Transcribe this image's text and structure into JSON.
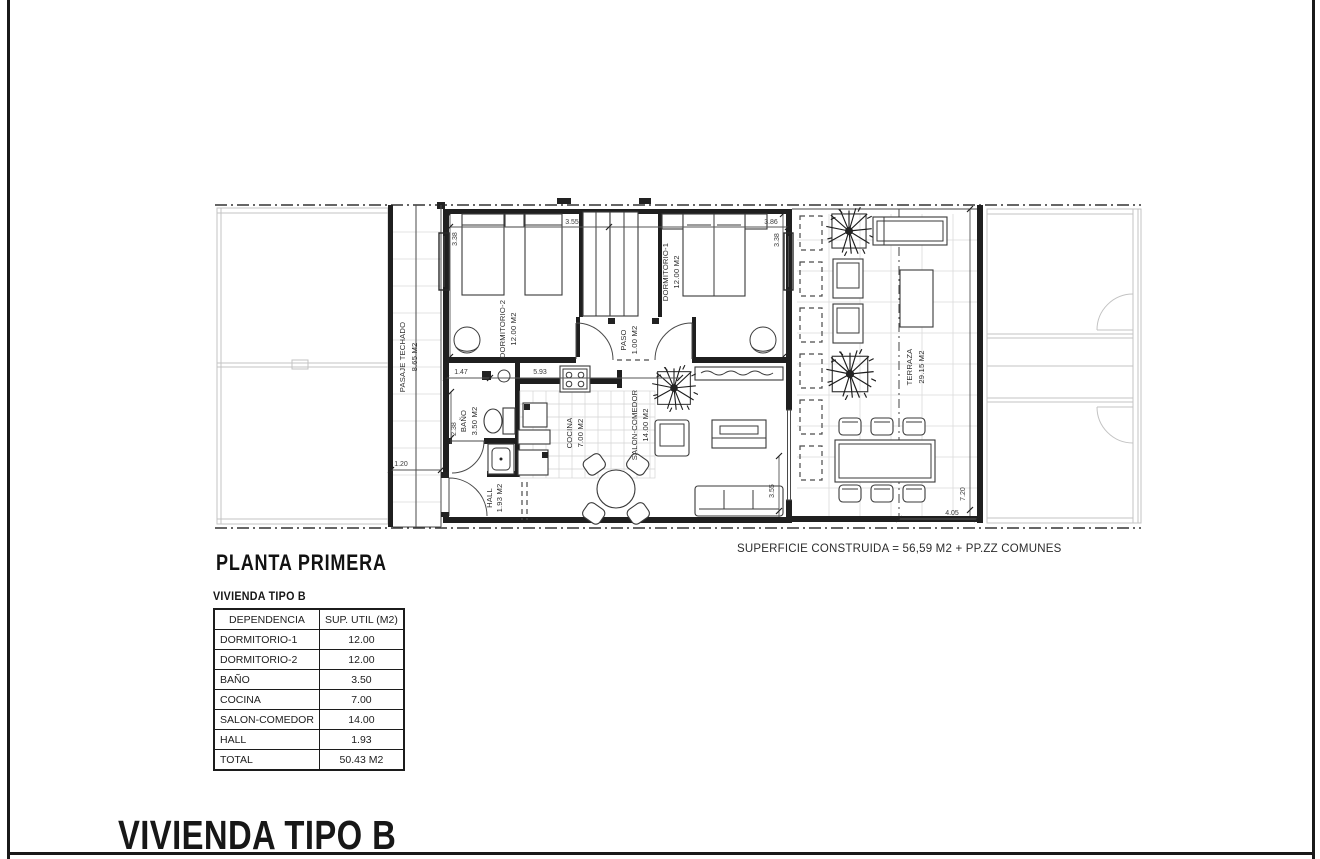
{
  "title_block": {
    "plan_title": "PLANTA PRIMERA",
    "type_heading": "VIVIENDA TIPO B",
    "footer_title": "VIVIENDA TIPO B",
    "superficie_note": "SUPERFICIE CONSTRUIDA = 56,59 M2 + PP.ZZ COMUNES"
  },
  "plan": {
    "rooms": [
      {
        "name": "PASAJE TECHADO",
        "area": "8.65 M2"
      },
      {
        "name": "DORMITORIO-2",
        "area": "12.00 M2"
      },
      {
        "name": "PASO",
        "area": "1.00 M2"
      },
      {
        "name": "DORMITORIO-1",
        "area": "12.00 M2"
      },
      {
        "name": "BAÑO",
        "area": "3.50 M2"
      },
      {
        "name": "COCINA",
        "area": "7.00 M2"
      },
      {
        "name": "SALON-COMEDOR",
        "area": "14.00 M2"
      },
      {
        "name": "HALL",
        "area": "1.93 M2"
      },
      {
        "name": "TERRAZA",
        "area": "29.15 M2"
      }
    ],
    "dims": {
      "left338": "3.38",
      "top355": "3.55",
      "top386": "3.86",
      "right338": "3.38",
      "w147": "1.47",
      "w593": "5.93",
      "w120": "1.20",
      "h238": "2.38",
      "h355": "3.55",
      "w405": "4.05",
      "h720": "7.20"
    }
  },
  "table": {
    "headers": [
      "DEPENDENCIA",
      "SUP. UTIL (M2)"
    ],
    "rows": [
      [
        "DORMITORIO-1",
        "12.00"
      ],
      [
        "DORMITORIO-2",
        "12.00"
      ],
      [
        "BAÑO",
        "3.50"
      ],
      [
        "COCINA",
        "7.00"
      ],
      [
        "SALON-COMEDOR",
        "14.00"
      ],
      [
        "HALL",
        "1.93"
      ]
    ],
    "total": {
      "label": "TOTAL",
      "value": "50.43 M2"
    }
  }
}
